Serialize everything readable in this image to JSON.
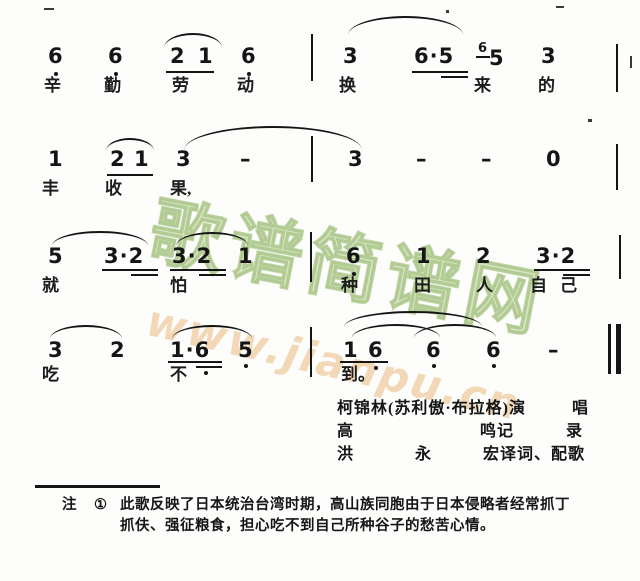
{
  "watermark": {
    "site_name": "歌谱简谱网",
    "site_url": "www.jianpu.cn",
    "green_color": "#a4c47a",
    "orange_color": "#ecc08a"
  },
  "score": {
    "lines": [
      {
        "notes": [
          "6",
          "6",
          "2",
          "1",
          "6",
          "3",
          "6·5",
          "6",
          "5",
          "3"
        ],
        "lyrics": [
          "辛",
          "勤",
          "劳",
          "动",
          "换",
          "来",
          "的"
        ]
      },
      {
        "notes": [
          "1",
          "2",
          "1",
          "3",
          "–",
          "3",
          "–",
          "–",
          "0"
        ],
        "lyrics": [
          "丰",
          "收",
          "果,"
        ]
      },
      {
        "notes": [
          "5",
          "3·2",
          "3·2",
          "1",
          "6",
          "1",
          "2",
          "3·2"
        ],
        "lyrics": [
          "就",
          "怕",
          "种",
          "田",
          "人",
          "自",
          "己"
        ]
      },
      {
        "notes": [
          "3",
          "2",
          "1·6",
          "5",
          "1",
          "6",
          "6",
          "6",
          "–"
        ],
        "lyrics": [
          "吃",
          "不",
          "到。"
        ]
      }
    ]
  },
  "credits": {
    "performer": "柯锦林(苏利傲·布拉格)演",
    "performer_suffix": "唱",
    "recorder_a": "高",
    "recorder_b": "鸣记",
    "recorder_c": "录",
    "translator_a": "洪",
    "translator_b": "永",
    "translator_c": "宏译词、配歌"
  },
  "footnote": {
    "label": "注",
    "marker": "①",
    "line1": "此歌反映了日本统治台湾时期，高山族同胞由于日本侵略者经常抓丁",
    "line2": "抓伕、强征粮食，担心吃不到自己所种谷子的愁苦心情。"
  }
}
